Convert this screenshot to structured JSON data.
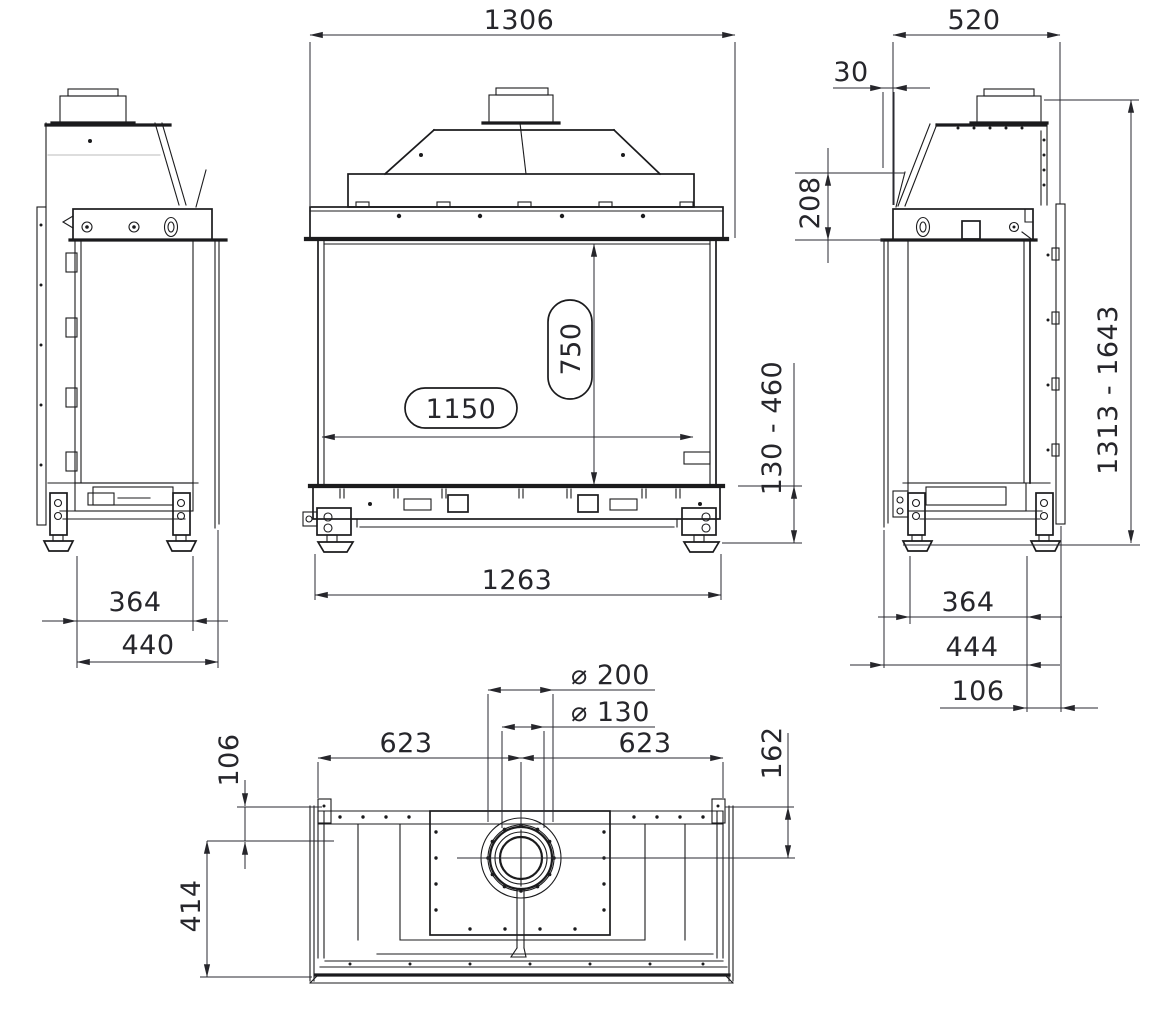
{
  "canvas": {
    "background": "#ffffff",
    "line_color": "#1b1b1d",
    "dimension_text_color": "#26262b"
  },
  "views": {
    "front": {
      "dims": {
        "overall_width": "1306",
        "glass_width": "1150",
        "glass_height": "750",
        "base_width": "1263",
        "height_adjust_range": "130 - 460"
      }
    },
    "left_side": {
      "dims": {
        "base_depth": "364",
        "overall_depth": "440"
      }
    },
    "right_side": {
      "dims": {
        "overall_depth": "520",
        "front_glass_offset": "30",
        "hood_section_height": "208",
        "overall_height_range": "1313 - 1643",
        "base_depth": "364",
        "body_depth": "444",
        "back_panel_offset": "106"
      }
    },
    "top": {
      "dims": {
        "flue_outer_diameter": "⌀ 200",
        "flue_inner_diameter": "⌀ 130",
        "flue_center_from_left": "623",
        "flue_center_from_right": "623",
        "back_to_flue_center": "162",
        "front_edge_offset": "106",
        "interior_depth": "414"
      }
    }
  }
}
